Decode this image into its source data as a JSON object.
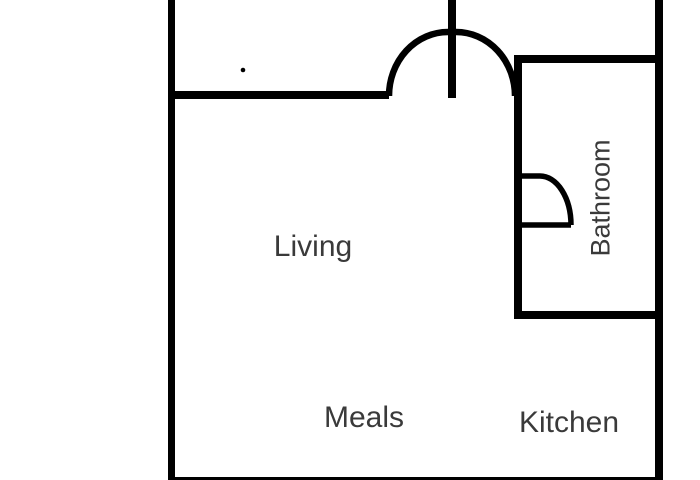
{
  "title": "Floor plan",
  "colors": {
    "background": "#ffffff",
    "wall": "#000000",
    "label": "#3a3a3a"
  },
  "rooms": {
    "living": {
      "label": "Living"
    },
    "meals": {
      "label": "Meals"
    },
    "kitchen": {
      "label": "Kitchen"
    },
    "bathroom": {
      "label": "Bathroom"
    }
  }
}
